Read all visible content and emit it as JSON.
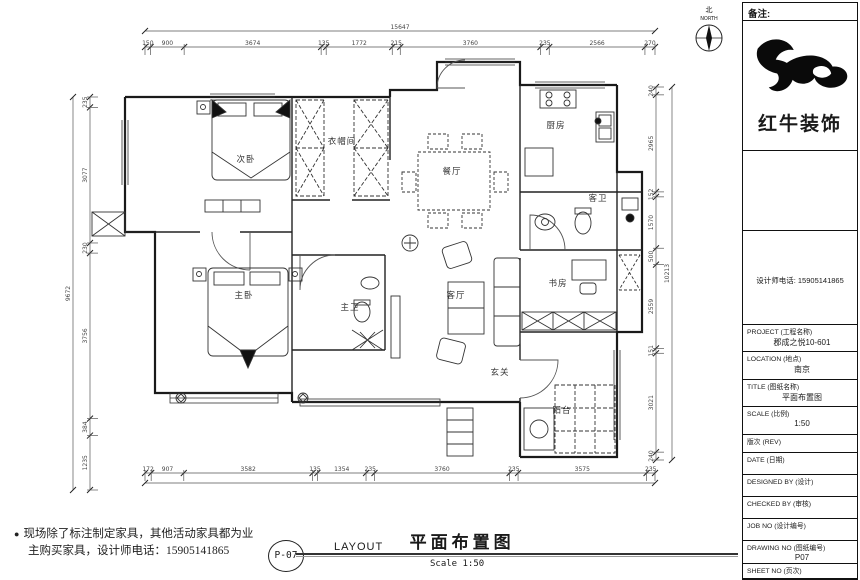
{
  "compass": {
    "label_cn": "北",
    "label_en": "NORTH"
  },
  "plan": {
    "rooms": [
      {
        "id": "bedroom-2",
        "label": "次卧",
        "x": 246,
        "y": 162
      },
      {
        "id": "cloakroom",
        "label": "衣帽间",
        "x": 342,
        "y": 144
      },
      {
        "id": "dining-room",
        "label": "餐厅",
        "x": 452,
        "y": 174
      },
      {
        "id": "kitchen",
        "label": "厨房",
        "x": 556,
        "y": 128
      },
      {
        "id": "guest-bath",
        "label": "客卫",
        "x": 598,
        "y": 201
      },
      {
        "id": "master-bedroom",
        "label": "主卧",
        "x": 244,
        "y": 298
      },
      {
        "id": "master-bath",
        "label": "主卫",
        "x": 350,
        "y": 310
      },
      {
        "id": "living-room",
        "label": "客厅",
        "x": 456,
        "y": 298
      },
      {
        "id": "study",
        "label": "书房",
        "x": 558,
        "y": 286
      },
      {
        "id": "entry",
        "label": "玄关",
        "x": 500,
        "y": 375
      },
      {
        "id": "balcony",
        "label": "阳台",
        "x": 562,
        "y": 413
      }
    ],
    "dim_chains": [
      {
        "id": "top",
        "orient": "h",
        "pos": 47,
        "start": 145,
        "end": 655,
        "values": [
          150,
          900,
          3674,
          135,
          1772,
          215,
          3760,
          235,
          2566,
          270
        ],
        "overall": {
          "pos": 31,
          "value": "15647"
        }
      },
      {
        "id": "bottom",
        "orient": "h",
        "pos": 473,
        "start": 145,
        "end": 655,
        "values": [
          172,
          907,
          3582,
          135,
          1354,
          235,
          3760,
          235,
          3575,
          235
        ],
        "overall": {
          "pos": 483,
          "value": ""
        }
      },
      {
        "id": "left",
        "orient": "v",
        "pos": 90,
        "start": 97,
        "end": 490,
        "values": [
          235,
          3077,
          230,
          3756,
          384,
          1235
        ],
        "overall": {
          "pos": 73,
          "value": "9672"
        }
      },
      {
        "id": "right",
        "orient": "v",
        "pos": 656,
        "start": 87,
        "end": 460,
        "values": [
          240,
          2965,
          152,
          1570,
          500,
          2559,
          151,
          3021,
          240
        ],
        "overall": {
          "pos": 672,
          "value": "10213"
        }
      }
    ]
  },
  "titleblock": {
    "remarks_label": "备注:",
    "brand": "红牛装饰",
    "phone_line": "设计师电话: 15905141865",
    "fields": [
      {
        "label": "PROJECT (工程名称)",
        "value": "郡成之悦10-601"
      },
      {
        "label": "LOCATION (地点)",
        "value": "南京"
      },
      {
        "label": "TITLE (图纸名称)",
        "value": "平面布置图"
      },
      {
        "label": "SCALE (比例)",
        "value": "1:50"
      },
      {
        "label": "版次 (REV)",
        "value": ""
      },
      {
        "label": "DATE  (日期)",
        "value": ""
      },
      {
        "label": "DESIGNED BY (设计)",
        "value": ""
      },
      {
        "label": "CHECKED BY (审核)",
        "value": ""
      },
      {
        "label": "JOB   NO (设计编号)",
        "value": ""
      },
      {
        "label": "DRAWING NO (图纸编号)",
        "value": "P07"
      },
      {
        "label": "SHEET NO (页次)",
        "value": ""
      }
    ]
  },
  "footer": {
    "note_line1": "现场除了标注制定家具，其他活动家具都为业",
    "note_line2": "主购买家具，设计师电话：15905141865",
    "page_ref": "P-07",
    "layout_en": "LAYOUT",
    "layout_cn": "平面布置图",
    "scale_text": "Scale  1:50"
  }
}
